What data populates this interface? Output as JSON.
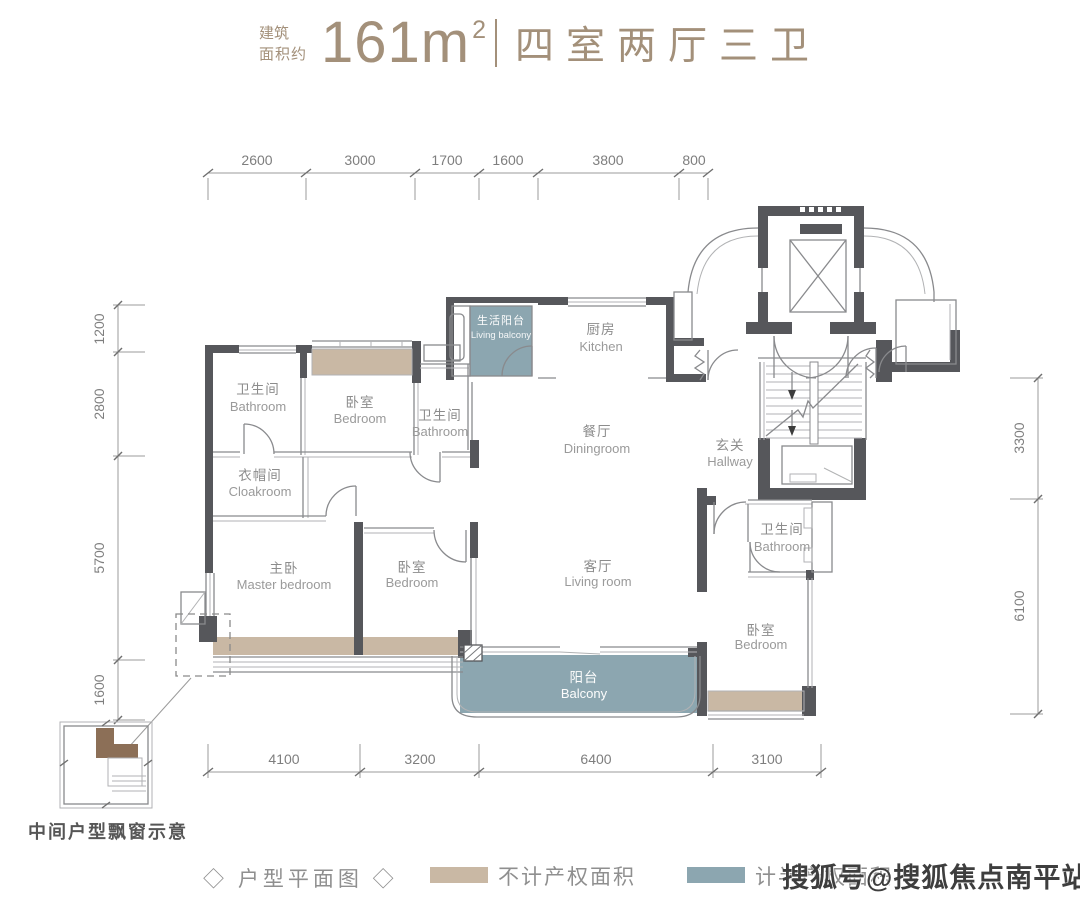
{
  "header": {
    "area_label_line1": "建筑",
    "area_label_line2": "面积约",
    "area_value": "161m",
    "area_superscript": "2",
    "layout_type": "四室两厅三卫"
  },
  "dimensions": {
    "top": [
      "2600",
      "3000",
      "1700",
      "1600",
      "3800",
      "800"
    ],
    "bottom": [
      "4100",
      "3200",
      "6400",
      "3100"
    ],
    "left": [
      "1200",
      "2800",
      "5700",
      "1600"
    ],
    "right": [
      "3300",
      "6100"
    ]
  },
  "rooms": {
    "bath1": {
      "cn": "卫生间",
      "en": "Bathroom"
    },
    "bed1": {
      "cn": "卧室",
      "en": "Bedroom"
    },
    "bath2": {
      "cn": "卫生间",
      "en": "Bathroom"
    },
    "lbalc": {
      "cn": "生活阳台",
      "en": "Living balcony"
    },
    "kitchen": {
      "cn": "厨房",
      "en": "Kitchen"
    },
    "dining": {
      "cn": "餐厅",
      "en": "Diningroom"
    },
    "hall": {
      "cn": "玄关",
      "en": "Hallway"
    },
    "cloak": {
      "cn": "衣帽间",
      "en": "Cloakroom"
    },
    "master": {
      "cn": "主卧",
      "en": "Master bedroom"
    },
    "bed2": {
      "cn": "卧室",
      "en": "Bedroom"
    },
    "living": {
      "cn": "客厅",
      "en": "Living room"
    },
    "bath3": {
      "cn": "卫生间",
      "en": "Bathroom"
    },
    "bed3": {
      "cn": "卧室",
      "en": "Bedroom"
    },
    "balc": {
      "cn": "阳台",
      "en": "Balcony"
    }
  },
  "callout": {
    "caption": "中间户型飘窗示意"
  },
  "legend": {
    "title": "◇ 户型平面图 ◇",
    "items": [
      {
        "label": "不计产权面积",
        "color": "#c9b8a4"
      },
      {
        "label": "计半产权面积",
        "color": "#8ca6b0"
      }
    ]
  },
  "watermark": "搜狐号@搜狐焦点南平站",
  "colors": {
    "wall": "#56575b",
    "accent_brown": "#a3907a",
    "non_property_area": "#c9b8a4",
    "half_property_area": "#8ca6b0"
  }
}
